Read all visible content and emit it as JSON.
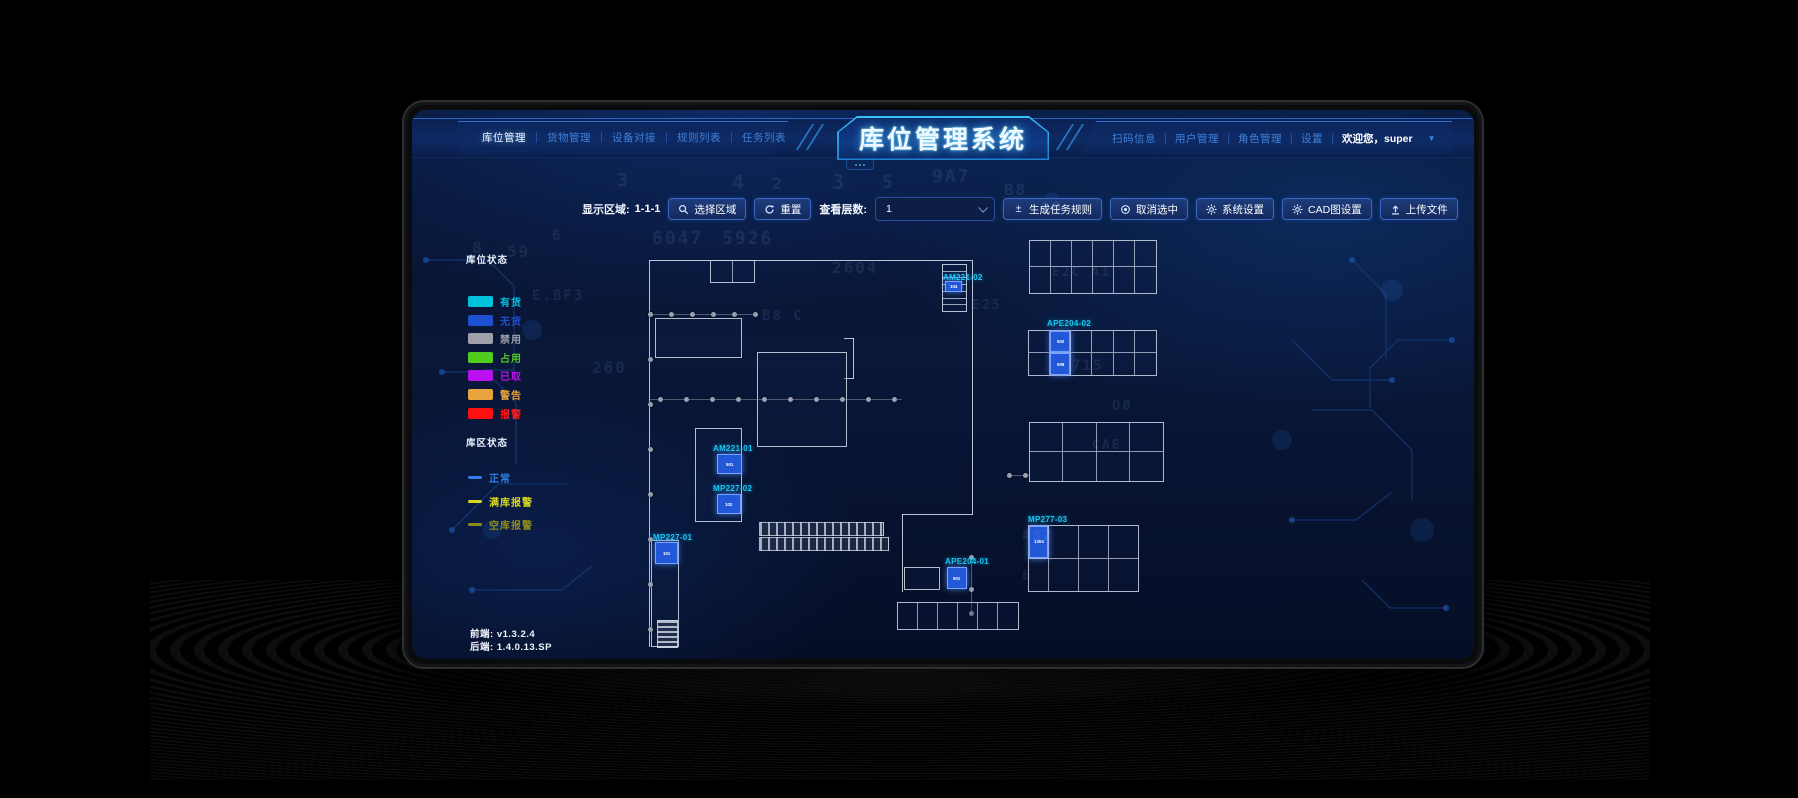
{
  "header": {
    "title": "库位管理系统",
    "left_nav": [
      {
        "label": "库位管理",
        "active": true
      },
      {
        "label": "货物管理",
        "active": false
      },
      {
        "label": "设备对接",
        "active": false
      },
      {
        "label": "规则列表",
        "active": false
      },
      {
        "label": "任务列表",
        "active": false
      }
    ],
    "right_nav": [
      {
        "label": "扫码信息"
      },
      {
        "label": "用户管理"
      },
      {
        "label": "角色管理"
      },
      {
        "label": "设置"
      }
    ],
    "welcome": "欢迎您，super"
  },
  "toolbar": {
    "display_area_label": "显示区域:",
    "display_area_value": "1-1-1",
    "select_area": "选择区域",
    "reset": "重置",
    "view_layers_label": "查看层数:",
    "view_layers_value": "1",
    "generate_task_rule": "生成任务规则",
    "generate_icon": "±",
    "cancel_selection": "取消选中",
    "system_settings": "系统设置",
    "cad_settings": "CAD图设置",
    "upload_file": "上传文件"
  },
  "legend": {
    "slot_status_title": "库位状态",
    "slot_statuses": [
      {
        "label": "有货",
        "color": "#00c2dc"
      },
      {
        "label": "无货",
        "color": "#1e50d2"
      },
      {
        "label": "禁用",
        "color": "#a0a0a8"
      },
      {
        "label": "占用",
        "color": "#52cc1e"
      },
      {
        "label": "已取",
        "color": "#bb10f0"
      },
      {
        "label": "警告",
        "color": "#e8a43c"
      },
      {
        "label": "报警",
        "color": "#ff1010"
      }
    ],
    "area_status_title": "库区状态",
    "area_statuses": [
      {
        "label": "正常",
        "color": "#2e7fe8"
      },
      {
        "label": "满库报警",
        "color": "#d8d820"
      },
      {
        "label": "空库报警",
        "color": "#8f8c1e"
      }
    ]
  },
  "plan": {
    "locations": [
      {
        "id": "AM221-02",
        "cells": [
          "104"
        ]
      },
      {
        "id": "APE204-02",
        "cells": [
          "502",
          "508"
        ]
      },
      {
        "id": "AM221-01",
        "cells": [
          "501"
        ]
      },
      {
        "id": "MP227-02",
        "cells": [
          "102"
        ]
      },
      {
        "id": "MP227-01",
        "cells": [
          "101"
        ]
      },
      {
        "id": "MP277-03",
        "cells": [
          "1304"
        ]
      },
      {
        "id": "APE204-01",
        "cells": [
          "901"
        ]
      }
    ]
  },
  "footer": {
    "frontend_label": "前端:",
    "frontend_version": "v1.3.2.4",
    "backend_label": "后端:",
    "backend_version": "1.4.0.13.SP"
  },
  "colors": {
    "accent_cyan": "#19c8f5",
    "highlight_cell": "#2257d8",
    "highlight_border": "#7aa2ff"
  },
  "decor_glyphs": [
    "8",
    "59",
    "6",
    "6047",
    "5926",
    "4",
    "3",
    "5",
    "9A7",
    "B8",
    "C0",
    "2604",
    "E25",
    "B8 C",
    "260",
    "715",
    "482",
    "CAE",
    "3F",
    "E.BF3",
    "D0",
    "3",
    "2",
    "E2C A1",
    "6"
  ]
}
